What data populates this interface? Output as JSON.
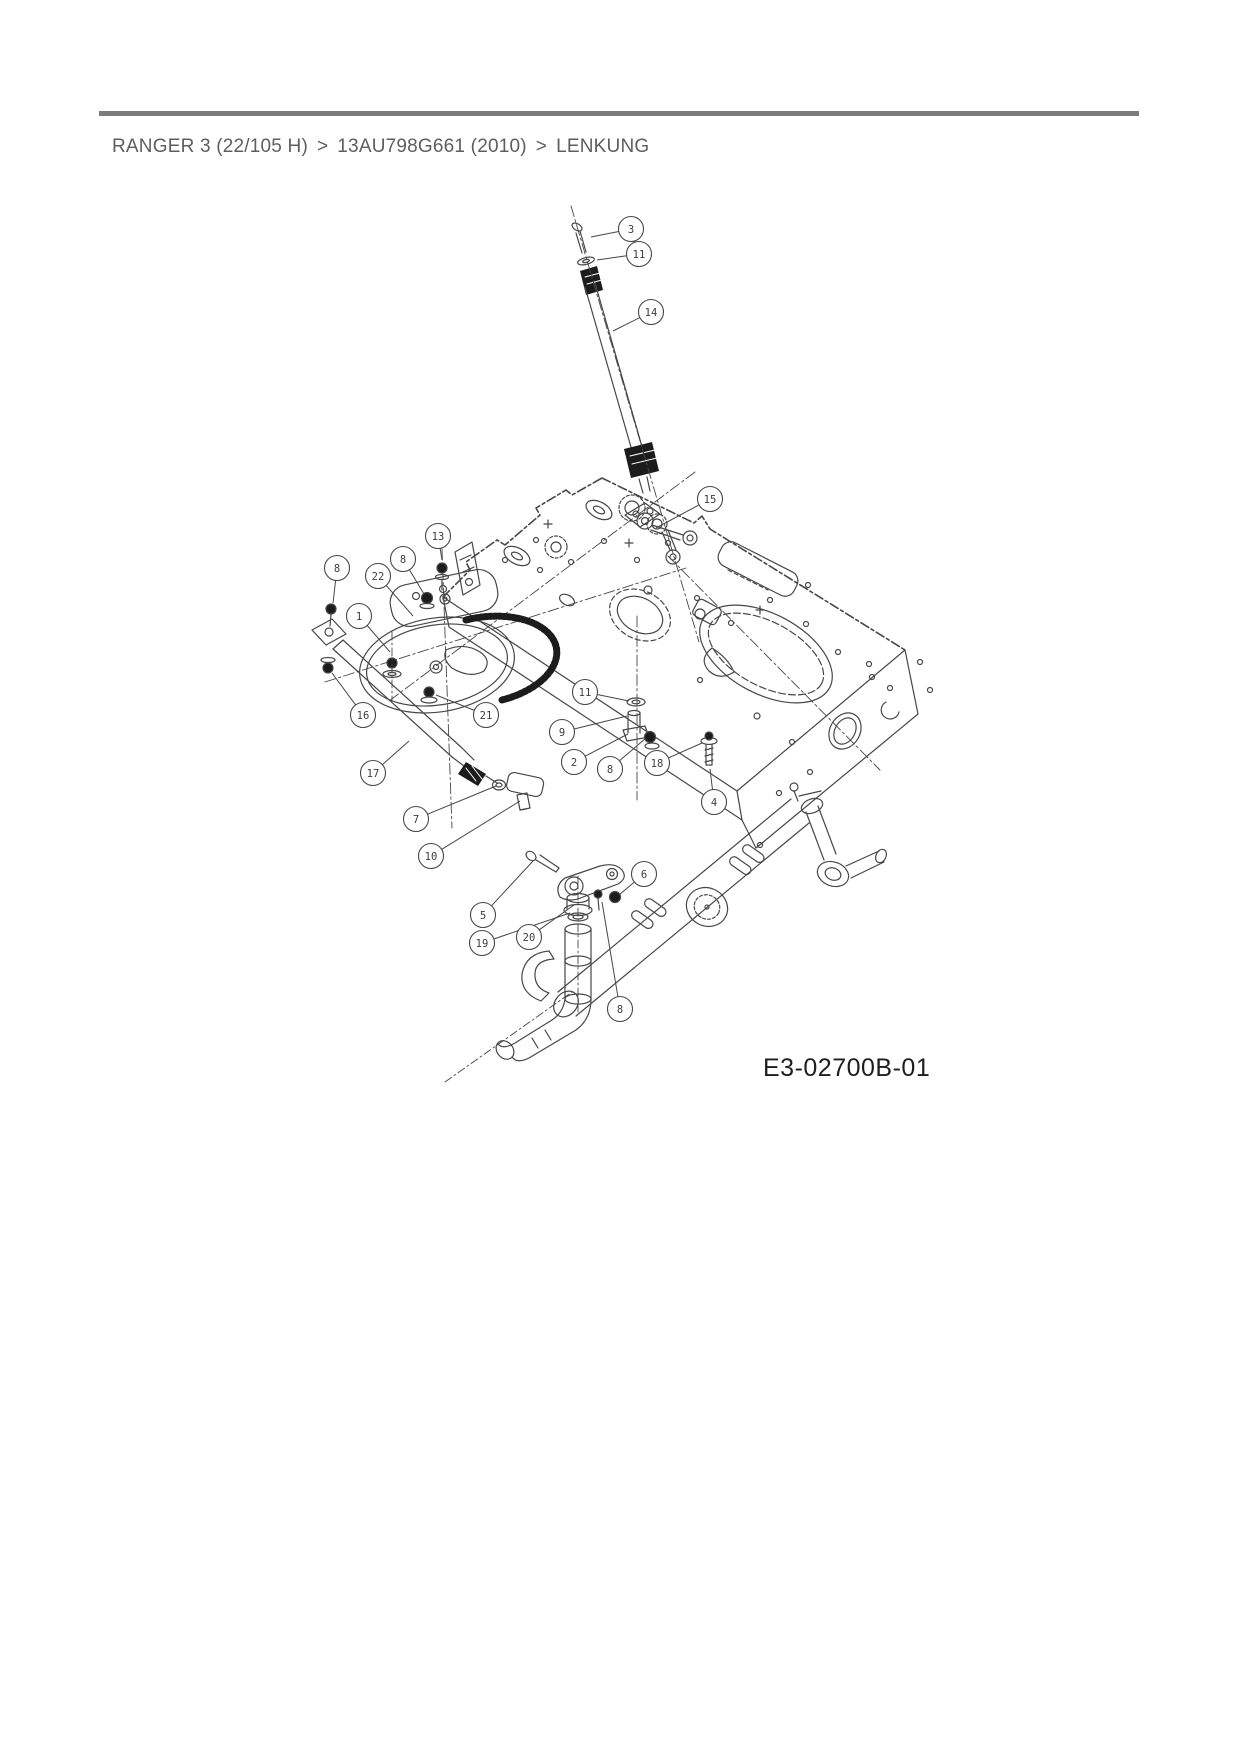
{
  "header": {
    "rule_color": "#7c7c7c",
    "breadcrumb": {
      "items": [
        "RANGER 3 (22/105 H)",
        "13AU798G661 (2010)",
        "LENKUNG"
      ],
      "separator": ">",
      "text_color": "#5e5e5e"
    }
  },
  "diagram": {
    "drawing_number": "E3-02700B-01",
    "line_color": "#474747",
    "dark_fill": "#1c1c1c",
    "callouts": [
      {
        "label": "3",
        "cx": 631,
        "cy": 229,
        "lx": 591,
        "ly": 237
      },
      {
        "label": "11",
        "cx": 639,
        "cy": 254,
        "lx": 597,
        "ly": 260
      },
      {
        "label": "14",
        "cx": 651,
        "cy": 312,
        "lx": 613,
        "ly": 331
      },
      {
        "label": "15",
        "cx": 710,
        "cy": 499,
        "lx": 656,
        "ly": 528
      },
      {
        "label": "13",
        "cx": 438,
        "cy": 536,
        "lx": 442,
        "ly": 560
      },
      {
        "label": "8",
        "cx": 337,
        "cy": 568,
        "lx": 333,
        "ly": 603
      },
      {
        "label": "8",
        "cx": 403,
        "cy": 559,
        "lx": 424,
        "ly": 594
      },
      {
        "label": "22",
        "cx": 378,
        "cy": 576,
        "lx": 413,
        "ly": 616
      },
      {
        "label": "1",
        "cx": 359,
        "cy": 616,
        "lx": 390,
        "ly": 652
      },
      {
        "label": "16",
        "cx": 363,
        "cy": 715,
        "lx": 332,
        "ly": 673
      },
      {
        "label": "21",
        "cx": 486,
        "cy": 715,
        "lx": 436,
        "ly": 695
      },
      {
        "label": "11",
        "cx": 585,
        "cy": 692,
        "lx": 629,
        "ly": 701
      },
      {
        "label": "9",
        "cx": 562,
        "cy": 732,
        "lx": 627,
        "ly": 716
      },
      {
        "label": "2",
        "cx": 574,
        "cy": 762,
        "lx": 628,
        "ly": 734
      },
      {
        "label": "8",
        "cx": 610,
        "cy": 769,
        "lx": 646,
        "ly": 738
      },
      {
        "label": "18",
        "cx": 657,
        "cy": 763,
        "lx": 702,
        "ly": 743
      },
      {
        "label": "4",
        "cx": 714,
        "cy": 802,
        "lx": 710,
        "ly": 769
      },
      {
        "label": "17",
        "cx": 373,
        "cy": 773,
        "lx": 409,
        "ly": 741
      },
      {
        "label": "7",
        "cx": 416,
        "cy": 819,
        "lx": 496,
        "ly": 786
      },
      {
        "label": "10",
        "cx": 431,
        "cy": 856,
        "lx": 520,
        "ly": 801
      },
      {
        "label": "6",
        "cx": 644,
        "cy": 874,
        "lx": 619,
        "ly": 895
      },
      {
        "label": "5",
        "cx": 483,
        "cy": 915,
        "lx": 533,
        "ly": 861
      },
      {
        "label": "19",
        "cx": 482,
        "cy": 943,
        "lx": 570,
        "ly": 913
      },
      {
        "label": "20",
        "cx": 529,
        "cy": 937,
        "lx": 574,
        "ly": 905
      },
      {
        "label": "8",
        "cx": 620,
        "cy": 1009,
        "lx": 602,
        "ly": 902
      }
    ]
  }
}
